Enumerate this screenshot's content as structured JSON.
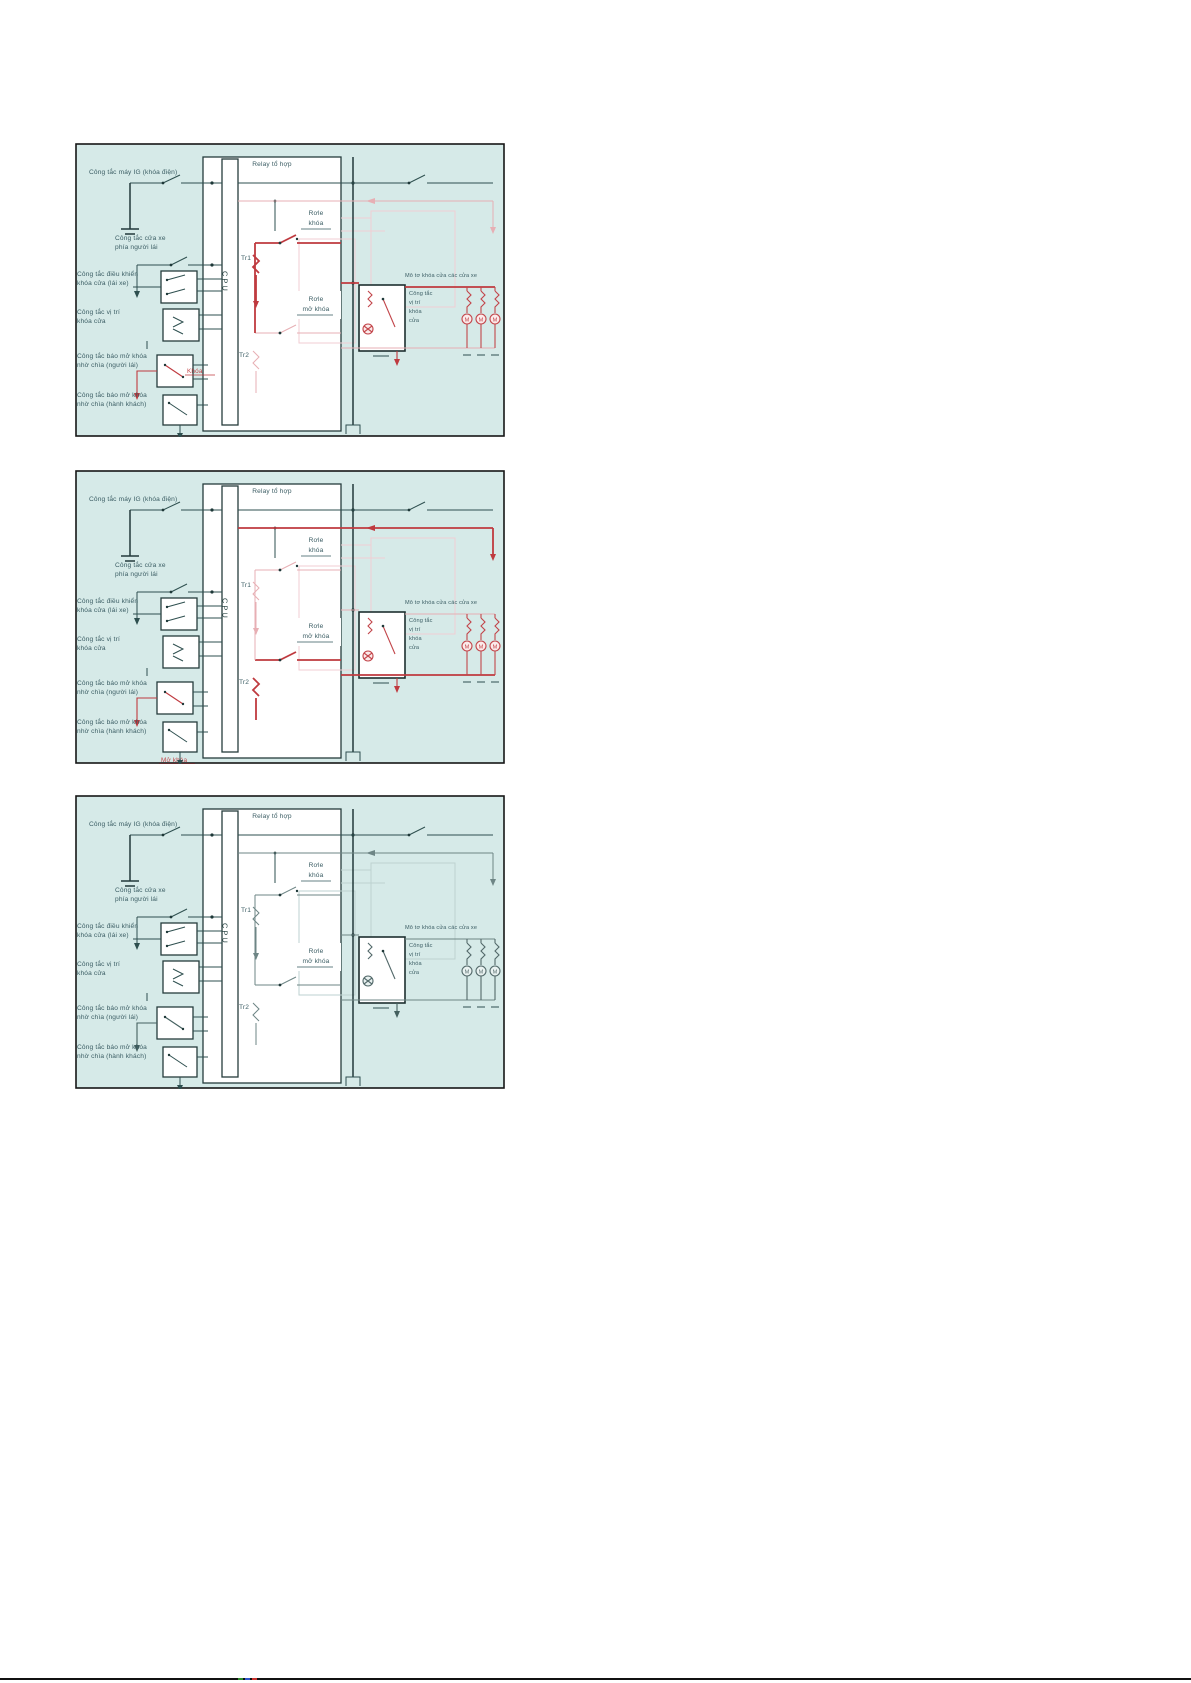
{
  "diagram": {
    "labels": {
      "ig_switch": "Công tắc máy IG (khóa điện)",
      "relay_title": "Relay tổ hợp",
      "cpu": "CPU",
      "door_sw_1": "Công tắc cửa xe",
      "door_sw_2": "phía người lái",
      "lock_ctrl_1": "Công tắc điều khiển",
      "lock_ctrl_2": "khóa cửa (lái xe)",
      "pos_sw_1": "Công tắc vị trí",
      "pos_sw_2": "khóa cửa",
      "key_driver_1": "Công tắc báo mở khóa",
      "key_driver_2": "nhờ chìa (người lái)",
      "key_pass_1": "Công tắc báo mở khóa",
      "key_pass_2": "nhờ chìa (hành khách)",
      "tr1": "Tr1",
      "tr2": "Tr2",
      "lock_relay_1": "Rơle",
      "lock_relay_2": "khóa",
      "unlock_relay_1": "Rơle",
      "unlock_relay_2": "mở khóa",
      "motor_header": "Mô tơ khóa cửa các cửa xe",
      "motor_sw_1": "Công tắc",
      "motor_sw_2": "vị trí",
      "motor_sw_3": "khóa",
      "motor_sw_4": "cửa",
      "motor_m": "M"
    },
    "panels": [
      {
        "id": "lock",
        "action_label": "Khóa"
      },
      {
        "id": "unlock",
        "action_label": "Mở khóa"
      },
      {
        "id": "neutral",
        "action_label": ""
      }
    ],
    "colors": {
      "panel_background": "#d6eae8",
      "active_red": "#bf3a3f",
      "ghost_pink": "#f0ced3",
      "wire_dark": "#2e4f4f"
    }
  },
  "footer": {
    "mark_colors": [
      "#2f8f2f",
      "#2f55c9",
      "#c9342f"
    ]
  }
}
